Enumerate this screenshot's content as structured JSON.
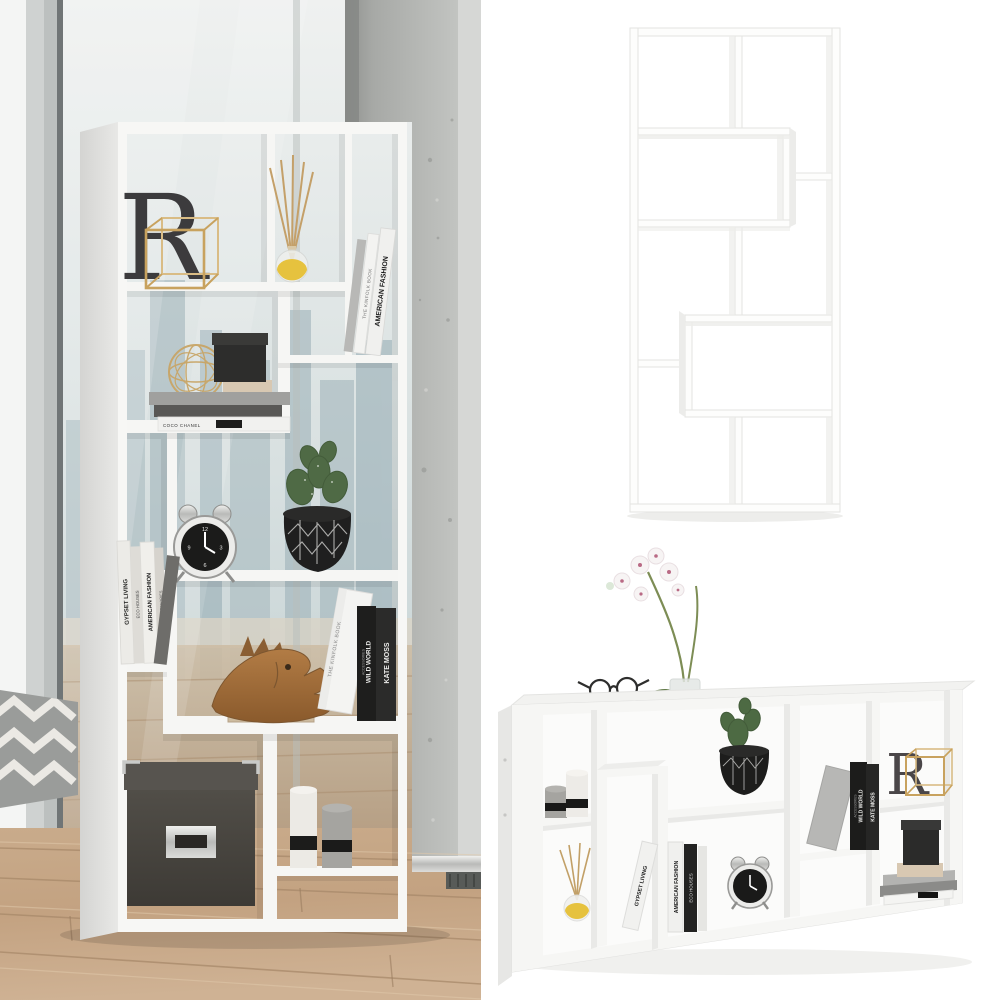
{
  "canvas": {
    "width": 1000,
    "height": 1000,
    "background": "#ffffff"
  },
  "texts": {
    "letter_r": "R",
    "the_kinfolk_book": "THE KINFOLK BOOK",
    "american_fashion": "AMERICAN FASHION",
    "accessories": "ACCESSORIES",
    "gypset_living": "GYPSET LIVING",
    "eco_houses": "ECO HOUSES",
    "wild_world": "WILD WORLD",
    "kate_moss": "KATE MOSS",
    "coco_chanel": "COCO CHANEL",
    "lisa_chaney": "LISA CHANEY",
    "the_little_black_jacket": "THE LITTLE BLACK JACKET",
    "clock_12": "12",
    "clock_3": "3",
    "clock_6": "6",
    "clock_9": "9"
  },
  "colors": {
    "shelf_white": "#f7f7f5",
    "render_white": "#fdfdfc",
    "glass_teal": "#c6d3d5",
    "city_silhouette": "#a3b6bc",
    "concrete": "#b3b5b2",
    "wood_floor": "#c4a585",
    "rug_grey": "#9a9c9a",
    "gold": "#c8a25e",
    "letter_dark": "#3c3b3d",
    "black_decor": "#262626",
    "storage_box": "#48453f",
    "candle_grey": "#a5a4a0",
    "diffuser_oil": "#e6c23e",
    "cactus_green": "#4d6a43",
    "fish_wood": "#a06b38"
  }
}
